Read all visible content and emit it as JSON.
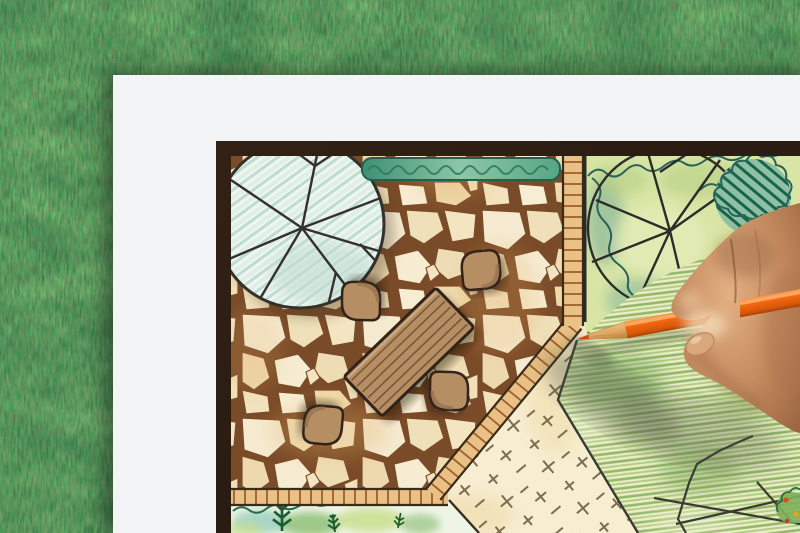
{
  "scene": {
    "description": "Overhead photo of a hand coloring a hand-drawn garden landscape plan with an orange pencil, paper lying on artificial grass",
    "background": "artificial-grass-lawn",
    "paper": "white-sheet-with-garden-plan",
    "plan_elements": [
      "round shade tree symbol on patio",
      "flagstone patio",
      "rectangular wooden dining table",
      "four rounded patio chairs",
      "clipped hedge strip",
      "brick edging bands",
      "shrub border with tree symbol and hatched bush",
      "cream lawn with turf tick marks",
      "green pencil-shaded lawn",
      "planting bed with conifer sprigs",
      "rock garden boundary lines",
      "flower accents in corner bed"
    ],
    "pencil": "orange colored pencil with sharpened wooden tip",
    "hand": "right hand holding pencil entering from right edge"
  },
  "colors": {
    "grass_base": "#2f5c33",
    "paper": "#f2f4f6",
    "plan_border": "#271c12",
    "plan_paper": "#f3e6c8",
    "stone_joint": "#754728",
    "wood_furniture": "#b68e63",
    "furniture_outline": "#30231a",
    "tree_fill": "#edf5f0",
    "hedge_green": "#57a584",
    "bed_green": "#d8e5a5",
    "lawn_cream": "#f7eed2",
    "pencil_orange": "#f1680f",
    "pencil_wood": "#e0a55e",
    "skin": "#c2895e"
  }
}
